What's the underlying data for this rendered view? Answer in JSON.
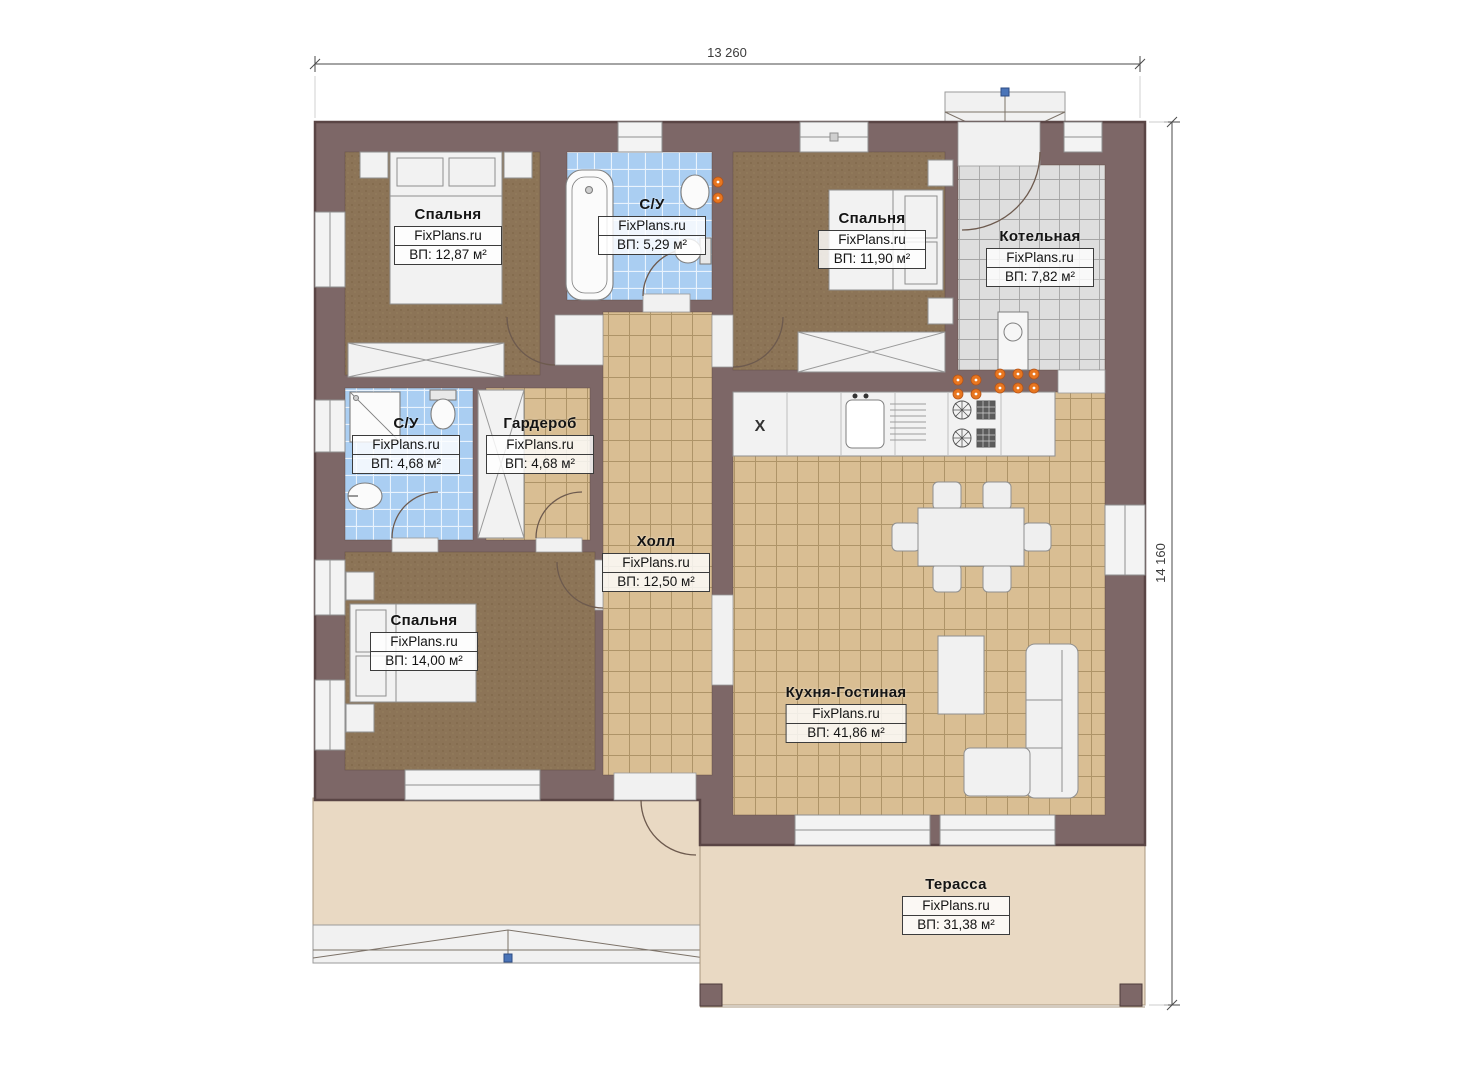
{
  "drawing": {
    "type": "floor-plan",
    "dimensions": {
      "width_label": "13 260",
      "height_label": "14 160"
    },
    "kitchen_marker": "X"
  },
  "rooms": [
    {
      "id": "bedroom-1",
      "name": "Спальня",
      "brand": "FixPlans.ru",
      "area": "ВП: 12,87 м²"
    },
    {
      "id": "bathroom-1",
      "name": "С/У",
      "brand": "FixPlans.ru",
      "area": "ВП: 5,29 м²"
    },
    {
      "id": "bedroom-2",
      "name": "Спальня",
      "brand": "FixPlans.ru",
      "area": "ВП: 11,90 м²"
    },
    {
      "id": "boiler-room",
      "name": "Котельная",
      "brand": "FixPlans.ru",
      "area": "ВП: 7,82 м²"
    },
    {
      "id": "bathroom-2",
      "name": "С/У",
      "brand": "FixPlans.ru",
      "area": "ВП: 4,68 м²"
    },
    {
      "id": "wardrobe",
      "name": "Гардероб",
      "brand": "FixPlans.ru",
      "area": "ВП: 4,68 м²"
    },
    {
      "id": "hall",
      "name": "Холл",
      "brand": "FixPlans.ru",
      "area": "ВП: 12,50 м²"
    },
    {
      "id": "bedroom-3",
      "name": "Спальня",
      "brand": "FixPlans.ru",
      "area": "ВП: 14,00 м²"
    },
    {
      "id": "kitchen-living",
      "name": "Кухня-Гостиная",
      "brand": "FixPlans.ru",
      "area": "ВП: 41,86 м²"
    },
    {
      "id": "terrace",
      "name": "Терасса",
      "brand": "FixPlans.ru",
      "area": "ВП: 31,38 м²"
    }
  ],
  "colors": {
    "wall": "#7d6767",
    "wall_edge": "#5a4545",
    "carpet": "#8c7457",
    "wood_tile": "#d9be93",
    "blue_tile": "#aacef2",
    "gray_tile": "#dedede",
    "terrace": "#e9d9c3",
    "fixture": "#f2f2f2",
    "outlet": "#e8761f",
    "node": "#4a74b8"
  }
}
